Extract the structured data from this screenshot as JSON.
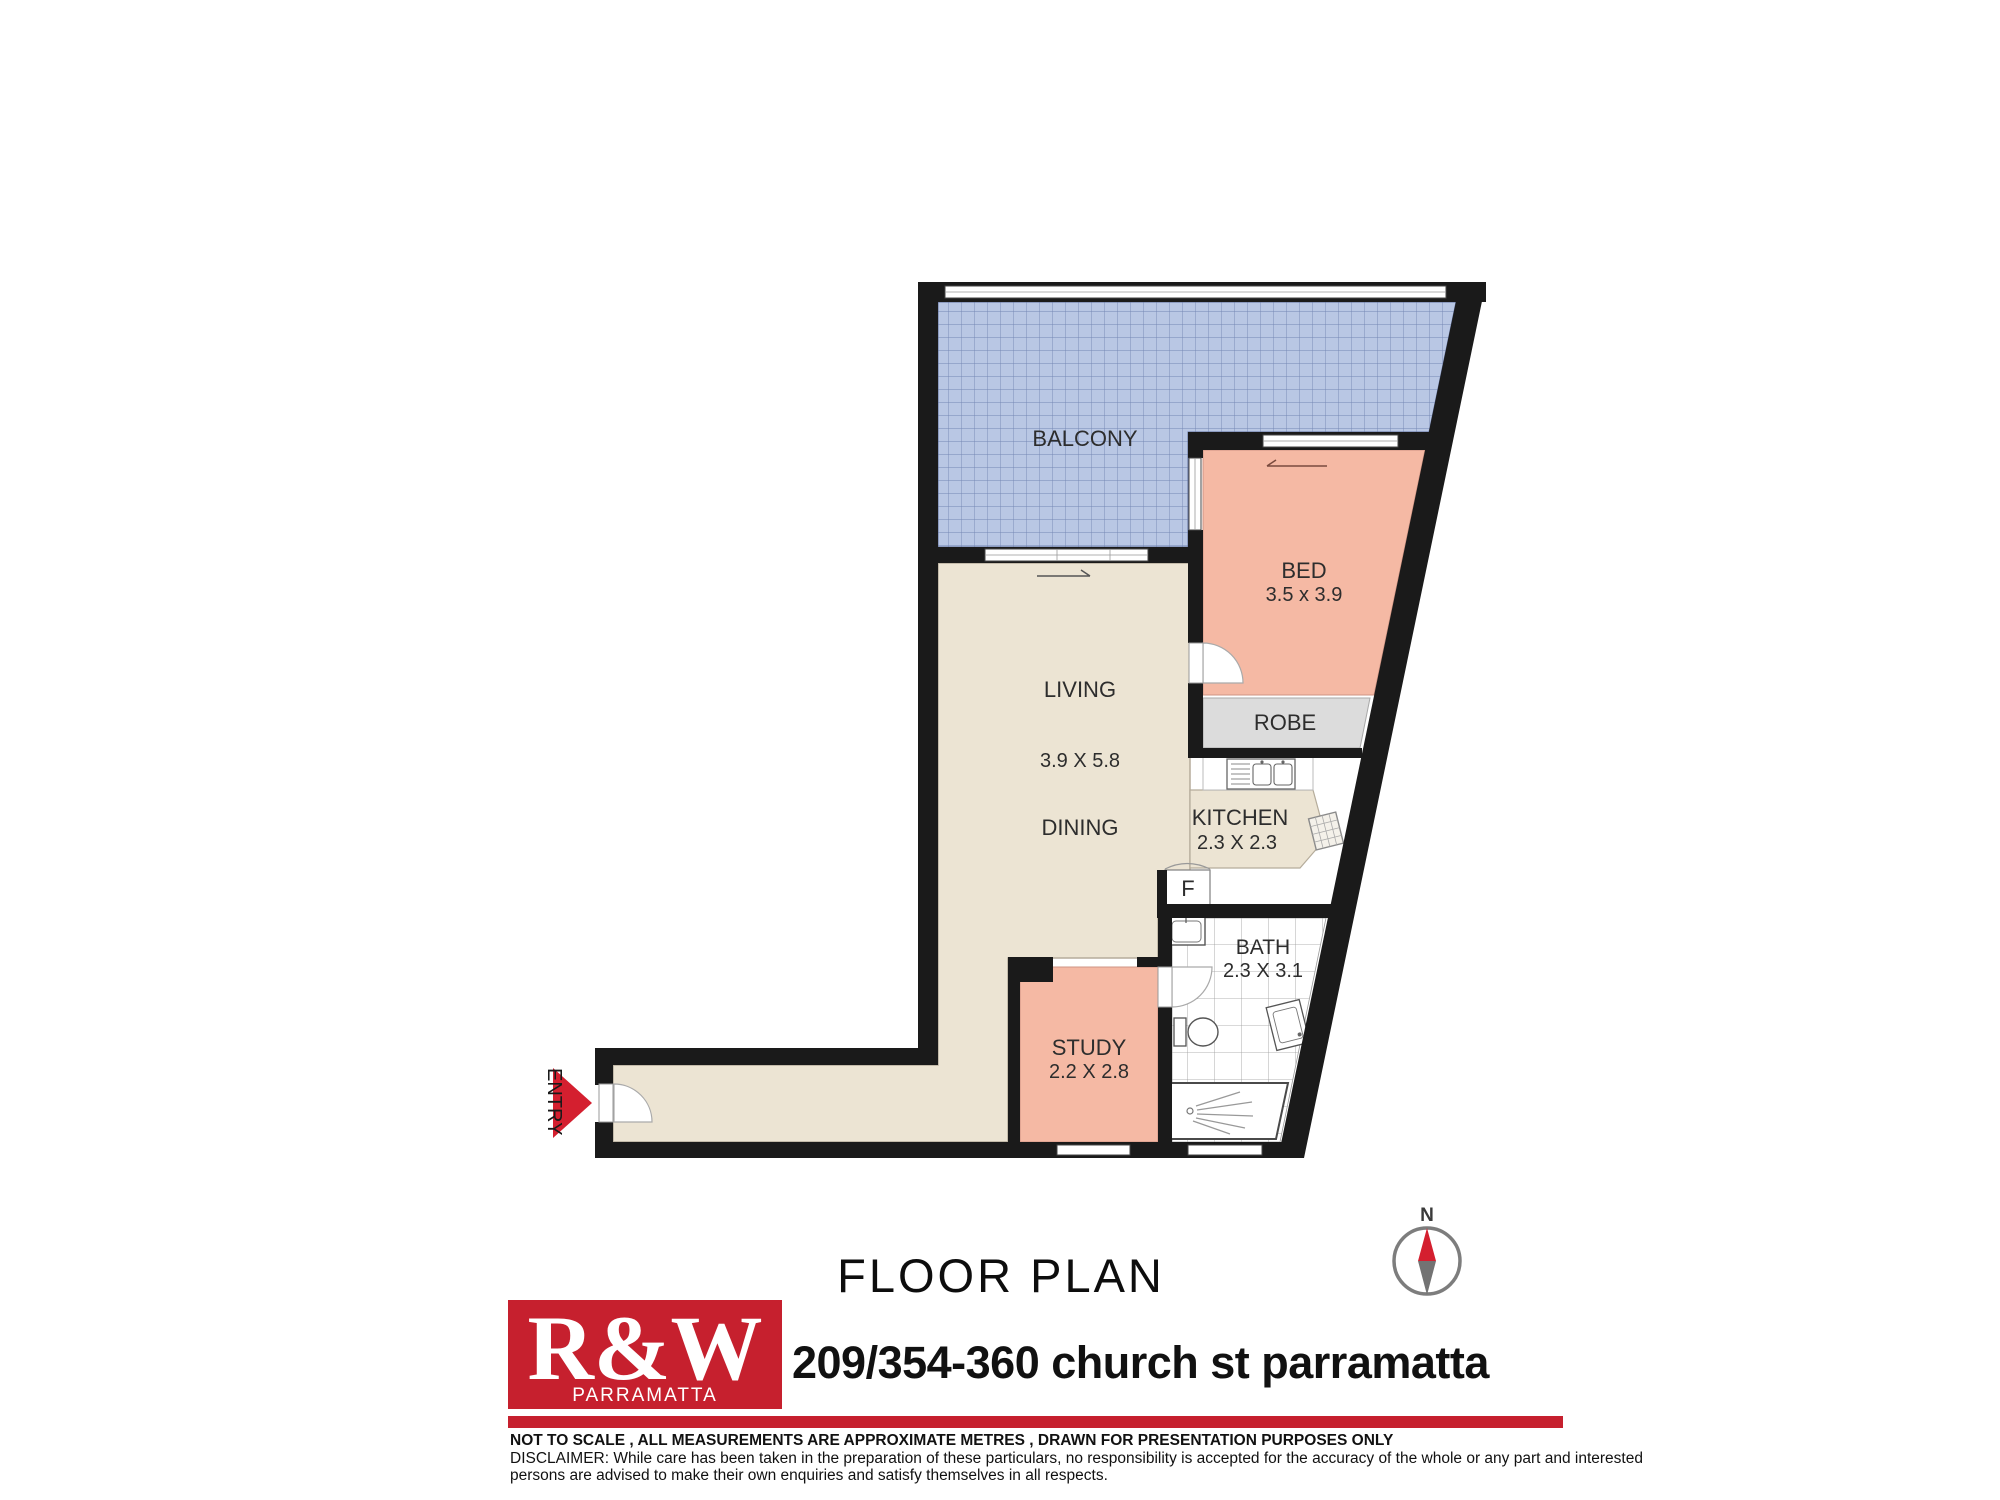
{
  "plan": {
    "rooms": {
      "balcony": {
        "label": "BALCONY"
      },
      "bed": {
        "label": "BED",
        "dims": "3.5 x 3.9"
      },
      "living": {
        "label": "LIVING",
        "dims": "3.9 X 5.8"
      },
      "dining": {
        "label": "DINING"
      },
      "kitchen": {
        "label": "KITCHEN",
        "dims": "2.3 X 2.3"
      },
      "robe": {
        "label": "ROBE"
      },
      "fridge": {
        "label": "F"
      },
      "bath": {
        "label": "BATH",
        "dims": "2.3 X 3.1"
      },
      "study": {
        "label": "STUDY",
        "dims": "2.2 X 2.8"
      },
      "entry": {
        "label": "ENTRY"
      }
    },
    "compass": {
      "north": "N"
    }
  },
  "footer": {
    "title": "FLOOR PLAN",
    "brand": {
      "name": "R&W",
      "location": "PARRAMATTA"
    },
    "address": "209/354-360 church st parramatta",
    "notes": {
      "scale": "NOT TO SCALE , ALL MEASUREMENTS ARE APPROXIMATE METRES , DRAWN FOR PRESENTATION PURPOSES ONLY",
      "disclaimer1": "DISCLAIMER:  While care has been taken in the preparation of these particulars, no responsibility is accepted for the accuracy of the whole or any part and interested",
      "disclaimer2": "persons are advised to make their own enquiries and satisfy  themselves in all respects."
    }
  },
  "colors": {
    "wall": "#1a1a1a",
    "balcony_fill": "#b9c7e4",
    "balcony_grid": "#7487b4",
    "floor_beige": "#ece4d3",
    "room_salmon": "#f5b9a4",
    "robe_gray": "#dcdcdc",
    "tile_line": "#9a9a9a",
    "accent_red": "#c6202e",
    "compass_ring": "#7d7d7d",
    "compass_south": "#737373"
  }
}
